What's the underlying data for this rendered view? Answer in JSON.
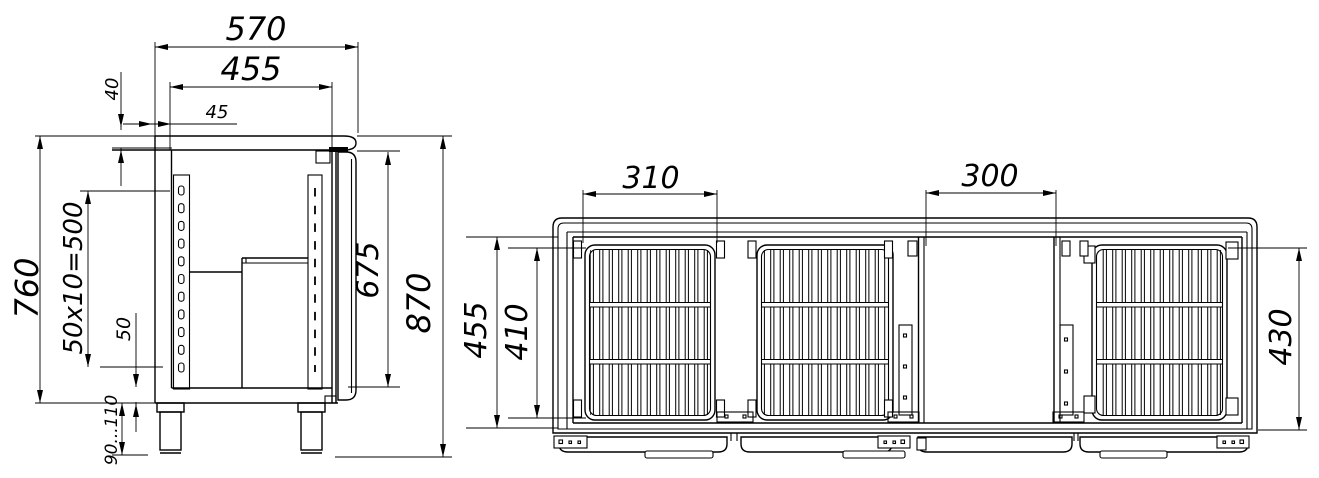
{
  "drawing": {
    "type": "technical-drawing",
    "description": "Two-view dimensioned CAD drawing of a refrigerated counter: side section view (left) and horizontal section plan view with wire shelves and machine compartment (right)",
    "units": "mm",
    "colors": {
      "line": "#000000",
      "background": "#ffffff"
    },
    "side_view": {
      "dims": {
        "overall_depth": "570",
        "interior_depth": "455",
        "rear_offset": "45",
        "worktop_thickness": "40",
        "body_height": "760",
        "rail_pitch": "50x10=500",
        "base_height": "50",
        "door_height": "675",
        "overall_height": "870",
        "leg_height": "90...110"
      }
    },
    "plan_view": {
      "dims": {
        "shelf_section_width": "310",
        "machine_section_width": "300",
        "interior_depth": "455",
        "shelf_depth": "410",
        "shelf_width": "430"
      }
    }
  }
}
